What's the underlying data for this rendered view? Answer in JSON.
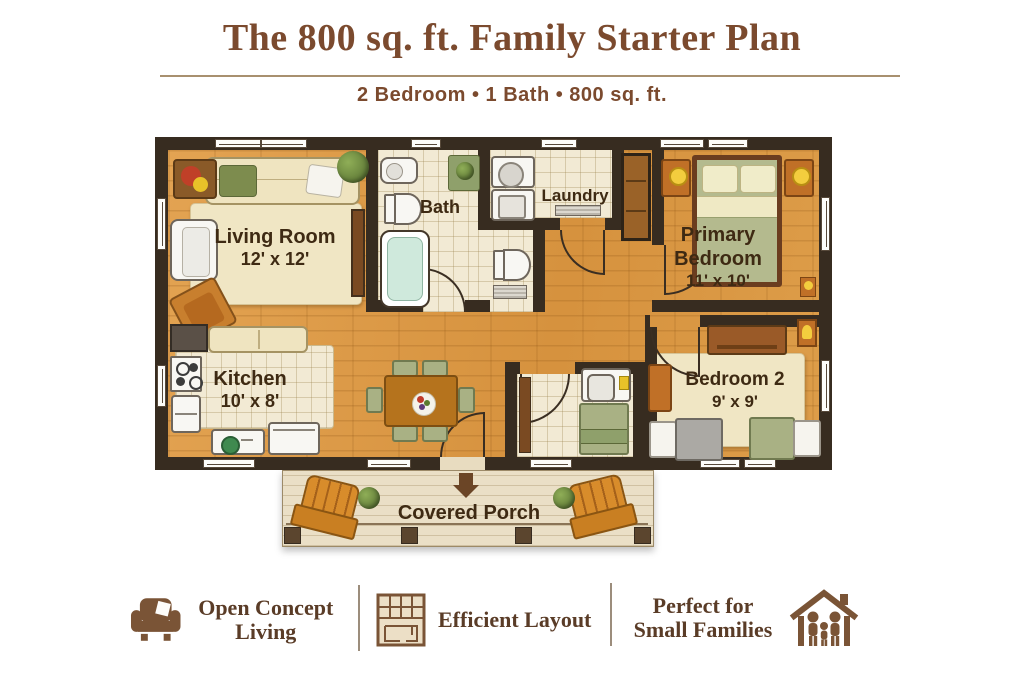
{
  "header": {
    "title": "The 800 sq. ft. Family Starter Plan",
    "subtitle": "2 Bedroom • 1 Bath • 800 sq. ft."
  },
  "rooms": {
    "living": {
      "name": "Living Room",
      "dims": "12' x 12'"
    },
    "bath": {
      "name": "Bath"
    },
    "laundry": {
      "name": "Laundry"
    },
    "primary": {
      "line1": "Primary",
      "line2": "Bedroom",
      "dims": "11' x 10'"
    },
    "kitchen": {
      "name": "Kitchen",
      "dims": "10' x 8'"
    },
    "bedroom2": {
      "name": "Bedroom 2",
      "dims": "9' x 9'"
    },
    "porch": {
      "name": "Covered Porch"
    }
  },
  "features": [
    {
      "icon": "armchair-icon",
      "line1": "Open Concept",
      "line2": "Living"
    },
    {
      "icon": "floorplan-icon",
      "line1": "Efficient Layout",
      "line2": ""
    },
    {
      "icon": "house-family-icon",
      "line1": "Perfect for",
      "line2": "Small Families"
    }
  ],
  "colors": {
    "title_brown": "#7b4a2e",
    "wall": "#372c20",
    "wood_floor": "#dd9b48",
    "tile": "#f2ead4",
    "accent_orange": "#c9821f",
    "sage_green": "#a9b184",
    "icon_brown": "#7a5639"
  }
}
